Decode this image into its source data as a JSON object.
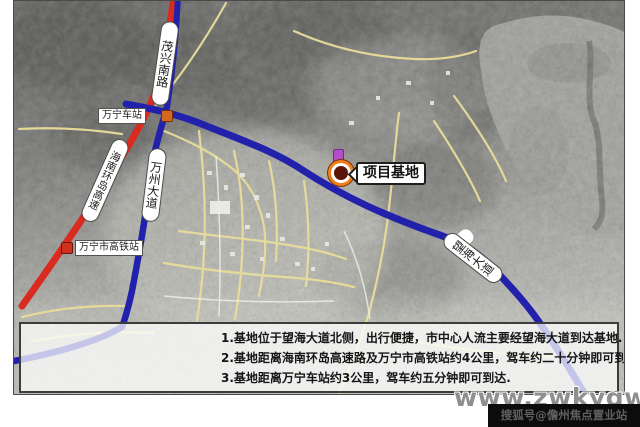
{
  "map": {
    "project_label": "项目基地",
    "road_labels": [
      {
        "id": "maoxing-south-road",
        "text": "茂兴南路"
      },
      {
        "id": "hainan-ring-expressway",
        "text": "海南环岛高速"
      },
      {
        "id": "wanzhou-avenue",
        "text": "万州大道"
      },
      {
        "id": "wanghai-avenue",
        "text": "望海大道"
      }
    ],
    "stations": [
      {
        "id": "wanning-railway-station",
        "text": "万宁车站"
      },
      {
        "id": "wanning-hsr-station",
        "text": "万宁市高铁站"
      }
    ],
    "colors": {
      "expressway_red": "#d92b20",
      "avenue_blue": "#2221ac",
      "street_yellow": "#e9dd9a",
      "marker_orange": "#ef7d18",
      "pin_purple": "#b24fc8"
    }
  },
  "panel": {
    "lines": [
      "1.基地位于望海大道北侧，出行便捷，市中心人流主要经望海大道到达基地.",
      "2.基地距离海南环岛高速路及万宁市高铁站约4公里，驾车约二十分钟即可到达.",
      "3.基地距离万宁车站约3公里，驾车约五分钟即可到达."
    ]
  },
  "watermark": "www.zwkygw.com",
  "credit": "搜狐号@儋州焦点置业站"
}
